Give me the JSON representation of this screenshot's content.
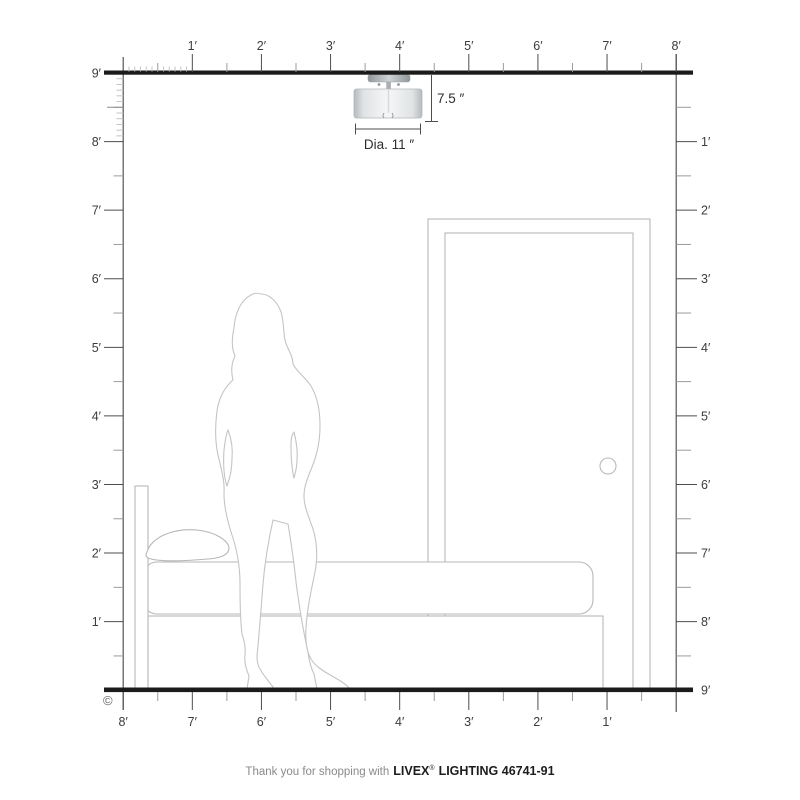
{
  "colors": {
    "structure": "#1b1b1b",
    "wall": "#555555",
    "tick_major": "#4d4d4d",
    "tick_minor": "#9b9b9b",
    "tick_half_inch": "#8d8d8d",
    "tick_fine": "#c3c3c3",
    "label": "#3c3c3c",
    "outline": "#bdbdbd",
    "shade_edge": "#b6babd",
    "shade_mid": "#f5f6f7",
    "metal": "#a9aeb2"
  },
  "rulers": {
    "top": {
      "labels": [
        "1′",
        "2′",
        "3′",
        "4′",
        "5′",
        "6′",
        "7′",
        "8′"
      ]
    },
    "left": {
      "labels": [
        "9′",
        "8′",
        "7′",
        "6′",
        "5′",
        "4′",
        "3′",
        "2′",
        "1′"
      ]
    },
    "right": {
      "labels": [
        "1′",
        "2′",
        "3′",
        "4′",
        "5′",
        "6′",
        "7′",
        "8′",
        "9′"
      ]
    },
    "bottom": {
      "labels": [
        "8′",
        "7′",
        "6′",
        "5′",
        "4′",
        "3′",
        "2′",
        "1′"
      ]
    }
  },
  "annotations": {
    "height": "7.5 ″",
    "diameter": "Dia. 11 ″"
  },
  "footer": {
    "copyright": "©",
    "thanks": "Thank you for shopping with",
    "brand": "LIVEX",
    "registered": "®",
    "product": "LIGHTING 46741-91"
  }
}
